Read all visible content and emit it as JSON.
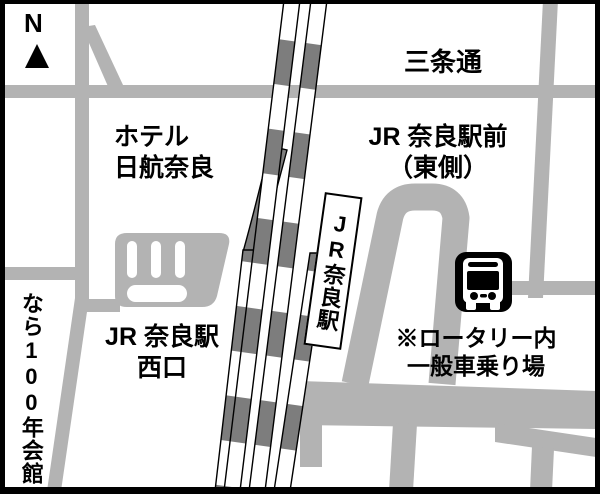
{
  "map": {
    "title": "JR奈良駅周辺地図",
    "compass": {
      "label": "N"
    },
    "labels": {
      "sanjo_dori": "三条通",
      "hotel_line1": "ホテル",
      "hotel_line2": "日航奈良",
      "east_exit_line1": "JR 奈良駅前",
      "east_exit_line2": "（東側）",
      "station_banner": "JR奈良駅",
      "west_exit_line1": "JR 奈良駅",
      "west_exit_line2": "西口",
      "hall_vertical": "なら100年会館",
      "rotary_note_line1": "※ロータリー内",
      "rotary_note_line2": "一般車乗り場"
    },
    "icons": {
      "bus": "bus-icon",
      "north_arrow": "north-arrow-icon"
    },
    "colors": {
      "background": "#ffffff",
      "road": "#b3b3b3",
      "rail_dark": "#7d7d7d",
      "ink": "#000000"
    }
  }
}
